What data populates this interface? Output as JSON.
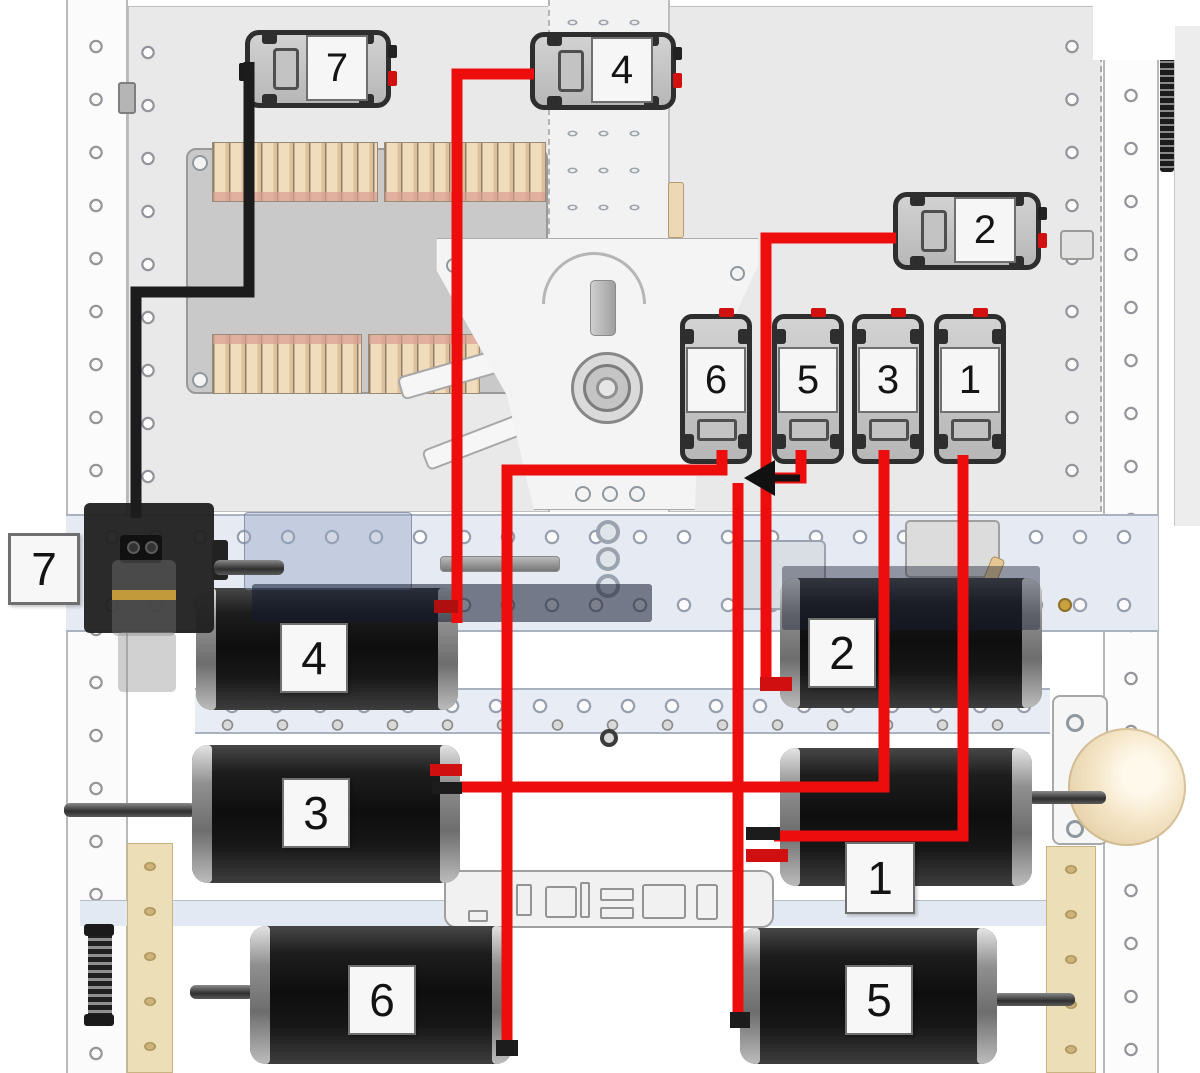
{
  "diagram": {
    "type": "wiring-diagram",
    "description": "Robot chassis wiring diagram: numbered motor controllers wired to numbered motors",
    "colors": {
      "signal_wire_red": "#ee0d0d",
      "power_wire_black": "#1c1c1c",
      "label_background": "#f7f7f7",
      "motor_body": "#141414",
      "frame_channel": "#e6ebf3",
      "battery_cell_tan": "#f1ddbc"
    },
    "controllers": [
      {
        "id": "controller-7",
        "label": "7"
      },
      {
        "id": "controller-4",
        "label": "4"
      },
      {
        "id": "controller-2",
        "label": "2"
      },
      {
        "id": "controller-6",
        "label": "6"
      },
      {
        "id": "controller-5",
        "label": "5"
      },
      {
        "id": "controller-3",
        "label": "3"
      },
      {
        "id": "controller-1",
        "label": "1"
      }
    ],
    "motors": [
      {
        "id": "motor-4",
        "label": "4"
      },
      {
        "id": "motor-2",
        "label": "2"
      },
      {
        "id": "motor-3",
        "label": "3"
      },
      {
        "id": "motor-1",
        "label": "1"
      },
      {
        "id": "motor-6",
        "label": "6"
      },
      {
        "id": "motor-5",
        "label": "5"
      }
    ],
    "device": {
      "id": "device-7",
      "label": "7"
    },
    "connections": [
      {
        "from": "controller-7",
        "to": "device-7",
        "wire": "black"
      },
      {
        "from": "controller-4",
        "to": "motor-4",
        "wire": "red"
      },
      {
        "from": "controller-2",
        "to": "motor-2",
        "wire": "red"
      },
      {
        "from": "controller-6",
        "to": "motor-6",
        "wire": "red"
      },
      {
        "from": "controller-5",
        "to": "motor-5",
        "wire": "red"
      },
      {
        "from": "controller-3",
        "to": "motor-3",
        "wire": "red"
      },
      {
        "from": "controller-1",
        "to": "motor-1",
        "wire": "red"
      }
    ]
  }
}
